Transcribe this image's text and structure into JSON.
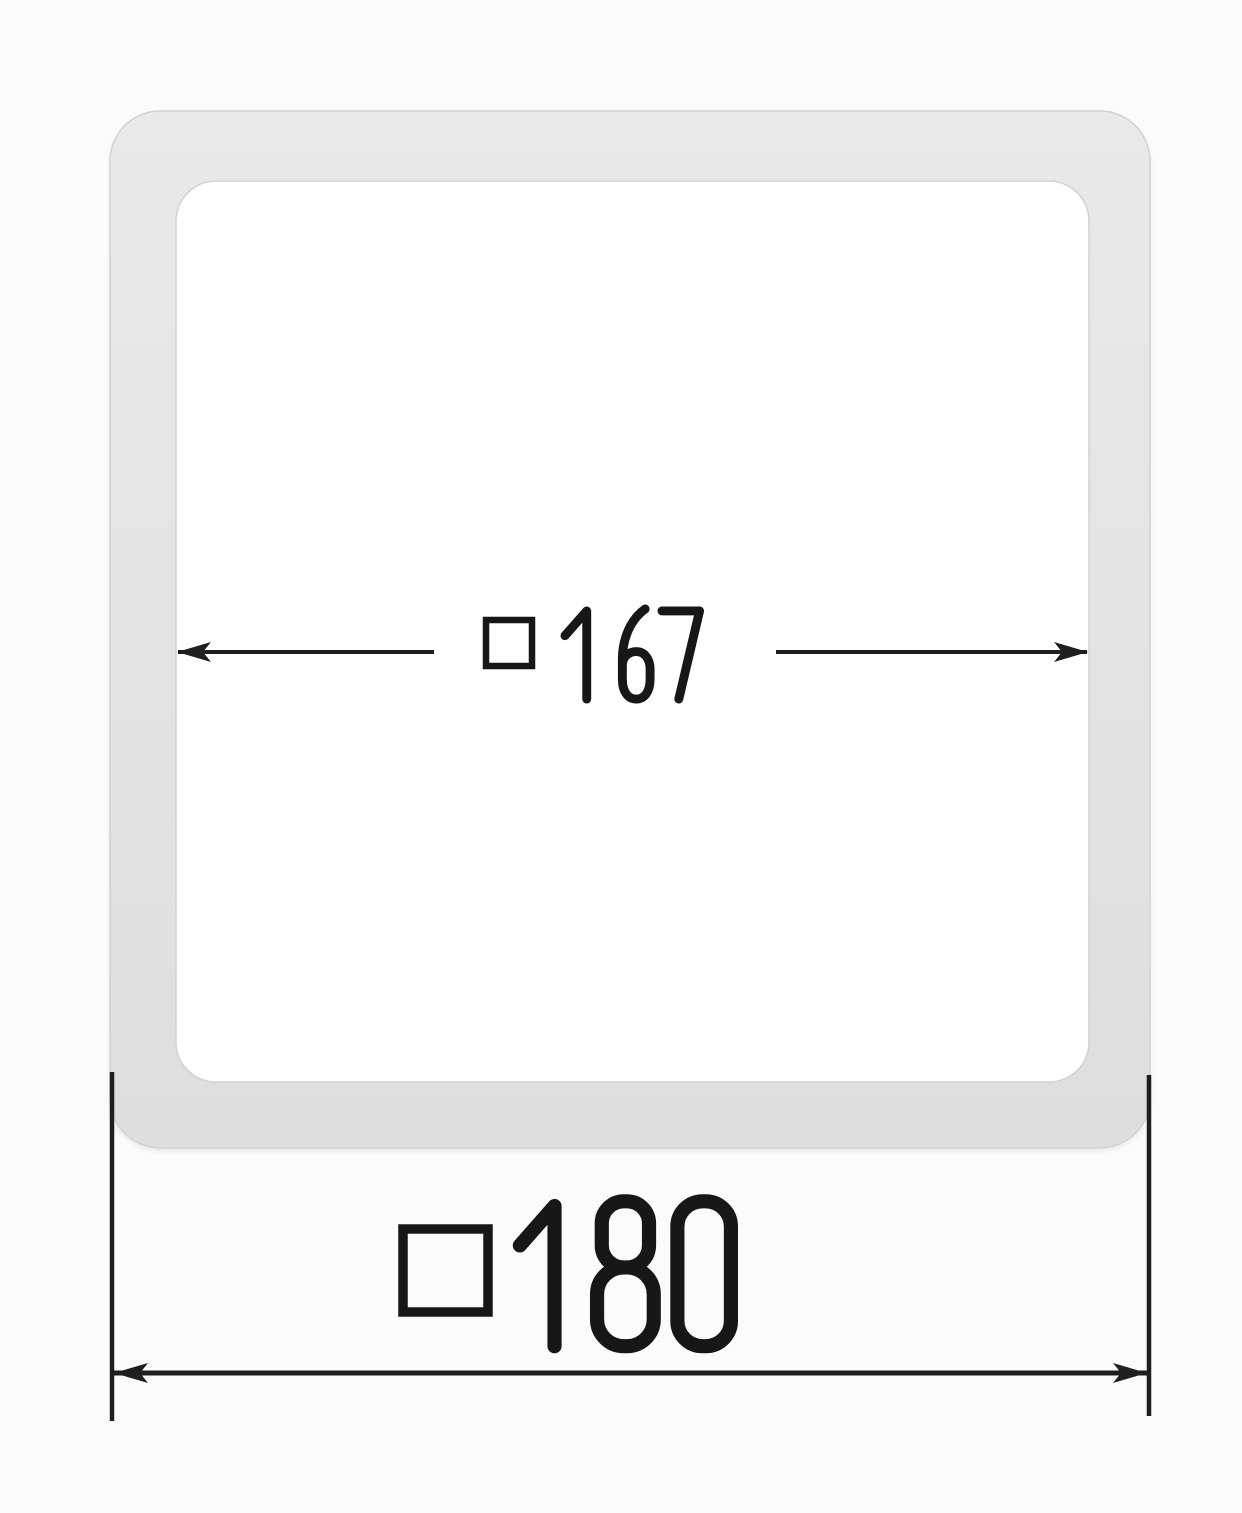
{
  "figure": {
    "description": "Dimensioned technical drawing of a square profile frame with rounded corners"
  },
  "dimensions": {
    "inner": {
      "symbol": "□",
      "value": "167",
      "label": "□ 167",
      "measures": "inner width (arrows span inner edges)"
    },
    "outer": {
      "symbol": "□",
      "value": "180",
      "label": "□180",
      "measures": "outer width (arrows span outer edges)"
    }
  },
  "colors": {
    "background": "#fbfbfb",
    "frame_fill_top": "#e9e9e9",
    "frame_fill_bottom": "#dedede",
    "frame_inner": "#ffffff",
    "frame_edge": "#d2d2d2",
    "line": "#1f1f1f",
    "text": "#171717"
  }
}
